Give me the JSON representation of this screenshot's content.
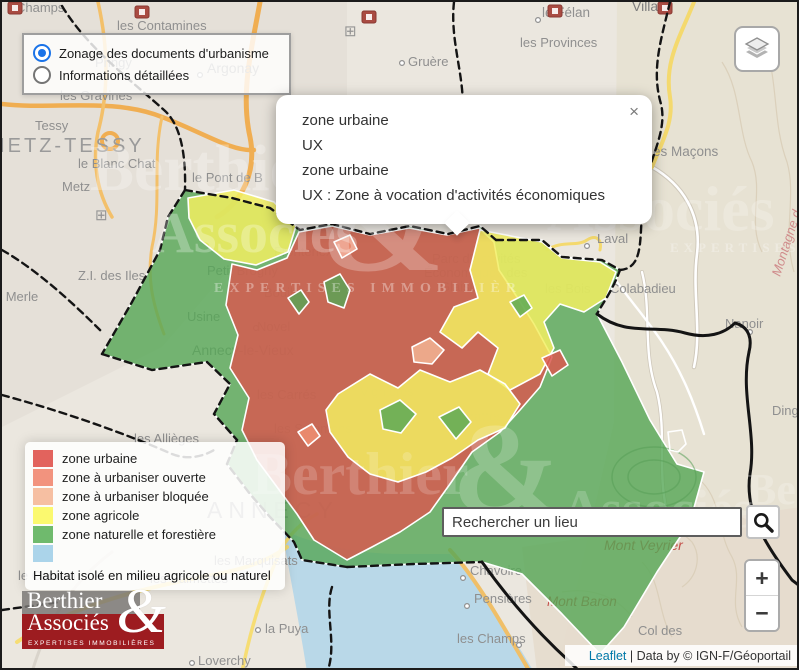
{
  "colors": {
    "zone_urbaine": "#e2635d",
    "zone_a_urbaniser_ouverte": "#f2937e",
    "zone_a_urbaniser_bloquee": "#f6bfa2",
    "zone_agricole": "#fbf96f",
    "zone_naturelle": "#6fba6d",
    "habitat_isole": "#abd4ea",
    "radio_accent": "#1a73e8",
    "leaflet_link": "#0078a8",
    "logo_red": "#9d1c20"
  },
  "mode_panel": {
    "options": [
      {
        "label": "Zonage des documents d'urbanisme",
        "selected": true
      },
      {
        "label": "Informations détaillées",
        "selected": false
      }
    ]
  },
  "popup": {
    "lines": [
      "zone urbaine",
      "UX",
      "zone urbaine",
      "UX : Zone à vocation d'activités économiques"
    ],
    "close_label": "×"
  },
  "legend": {
    "items": [
      {
        "label": "zone urbaine",
        "color": "#e2635d"
      },
      {
        "label": "zone à urbaniser ouverte",
        "color": "#f2937e"
      },
      {
        "label": "zone à urbaniser bloquée",
        "color": "#f6bfa2"
      },
      {
        "label": "zone agricole",
        "color": "#fbf96f"
      },
      {
        "label": "zone naturelle et forestière",
        "color": "#6fba6d"
      },
      {
        "label": "",
        "color": "#abd4ea"
      }
    ],
    "footnote": "Habitat isolé en milieu agricole ou naturel"
  },
  "search": {
    "placeholder": "Rechercher un lieu"
  },
  "zoom_control": {
    "zoom_in": "+",
    "zoom_out": "−"
  },
  "attribution": {
    "leaflet": "Leaflet",
    "separator": " | ",
    "text": "Data by © IGN-F/Géoportail"
  },
  "logo": {
    "line1": "Berthier",
    "line2": "Associés",
    "ampersand": "&",
    "tagline": "EXPERTISES IMMOBILIÈRES"
  },
  "map": {
    "base_shapes": [
      {
        "name": "urban-area-northwest",
        "path": "M0,0 L345,0 L345,130 L255,235 L160,345 L0,425 Z",
        "fill": "#e4dfd7",
        "op": 0.9
      },
      {
        "name": "mountain-area-east",
        "path": "M615,0 L799,0 L799,670 L555,670 L612,420 Z",
        "fill": "#e7e1d2",
        "op": 0.9
      },
      {
        "name": "shore-area-southeast",
        "path": "M520,545 L799,505 L799,670 L535,670 Z",
        "fill": "#e5dccd",
        "op": 0.9
      },
      {
        "name": "lake",
        "path": "M280,528 C320,545 360,552 400,552 L448,552 C470,575 495,612 520,650 L532,670 L305,670 C298,625 288,575 280,528 Z",
        "fill": "#b9d8e8",
        "op": 1
      }
    ],
    "roads": [
      {
        "path": "M650,165 C680,182 700,212 695,252 C690,290 700,330 692,365",
        "stroke": "#cfc8ba",
        "w": 4.5
      },
      {
        "path": "M650,165 C680,182 700,212 695,252 C690,290 700,330 692,365",
        "stroke": "#ffffff",
        "w": 2.6
      },
      {
        "path": "M640,270 C650,310 640,350 655,390 C665,430 655,470 665,510",
        "stroke": "#cfc8ba",
        "w": 4
      },
      {
        "path": "M640,270 C650,310 640,350 655,390 C665,430 655,470 665,510",
        "stroke": "#ffffff",
        "w": 2.4
      },
      {
        "path": "M600,258 C620,290 640,310 660,340 C680,370 692,400 702,432",
        "stroke": "#ffffff",
        "w": 2.4
      },
      {
        "path": "M258,0 C250,45 238,90 248,135 C255,170 240,200 215,215",
        "stroke": "#f0ae52",
        "w": 5
      },
      {
        "path": "M0,102 C50,108 110,95 160,115 C200,130 230,150 252,148",
        "stroke": "#f0ae52",
        "w": 4.5
      },
      {
        "path": "M96,0 C105,40 108,85 96,130 C90,160 95,190 110,215",
        "stroke": "#f3c06a",
        "w": 3.5
      },
      {
        "path": "M160,115 C150,160 160,200 150,245 C145,275 150,300 162,332",
        "stroke": "#f3c06a",
        "w": 3
      },
      {
        "circle": [
          108,
          139,
          8
        ],
        "stroke": "#f0ae52",
        "w": 4
      },
      {
        "path": "M692,0 C678,35 662,60 668,95 C672,120 660,140 650,165",
        "stroke": "#f4d96e",
        "w": 4
      },
      {
        "path": "M545,248 C560,238 575,245 585,238 C595,232 600,238 598,248",
        "stroke": "#f4d96e",
        "w": 3
      },
      {
        "path": "M15,640 C60,610 120,590 200,575 C240,568 265,560 285,545",
        "stroke": "#f6dd74",
        "w": 4
      },
      {
        "path": "M240,670 C250,620 262,585 280,545 C290,530 300,520 315,512",
        "stroke": "#f6dd74",
        "w": 3.5
      },
      {
        "path": "M448,548 C470,572 492,608 515,648 L528,670",
        "stroke": "#f0bf68",
        "w": 4
      },
      {
        "path": "M30,670 C45,620 70,580 110,550",
        "stroke": "#d9d4cb",
        "w": 3
      }
    ],
    "contours": [
      {
        "path": "M720,60 C740,90 735,130 750,160 C762,190 745,220 760,250"
      },
      {
        "path": "M762,40 C777,80 770,120 785,160 C795,195 780,230 792,270"
      },
      {
        "path": "M700,480 C720,500 715,530 730,555 C742,578 725,600 740,625"
      },
      {
        "path": "M640,560 C660,580 655,610 670,635"
      },
      {
        "path": "M610,520 C640,510 670,520 690,540 C700,555 695,575 680,585"
      },
      {
        "path": "M560,590 C590,585 615,595 630,615"
      }
    ],
    "labels": [
      {
        "t": "Champs",
        "x": 14,
        "y": 10
      },
      {
        "t": "les Contamines",
        "x": 115,
        "y": 28
      },
      {
        "t": "le Félan",
        "x": 540,
        "y": 15,
        "fs": 13.5
      },
      {
        "t": "les Provinces",
        "x": 518,
        "y": 45
      },
      {
        "t": "Villaz",
        "x": 630,
        "y": 9,
        "fs": 14,
        "c": "#7d7d7d"
      },
      {
        "t": "Gruère",
        "x": 406,
        "y": 64
      },
      {
        "t": "Argonay",
        "x": 205,
        "y": 71,
        "fs": 14
      },
      {
        "t": "Pringy",
        "x": 93,
        "y": 65
      },
      {
        "t": "les Gravines",
        "x": 58,
        "y": 98
      },
      {
        "t": "Tessy",
        "x": 33,
        "y": 128
      },
      {
        "t": "METZ-TESSY",
        "x": -14,
        "y": 150,
        "fs": 20,
        "ls": 3,
        "c": "#9a9a9a"
      },
      {
        "t": "le Blanc Chat",
        "x": 76,
        "y": 166
      },
      {
        "t": "Metz",
        "x": 60,
        "y": 189
      },
      {
        "t": "le Pont de B",
        "x": 190,
        "y": 180
      },
      {
        "t": "les Maçons",
        "x": 648,
        "y": 154,
        "fs": 13.5
      },
      {
        "t": "Z.I. des Iles",
        "x": 76,
        "y": 278
      },
      {
        "t": "le Merle",
        "x": -10,
        "y": 299
      },
      {
        "t": "Petit Brogny",
        "x": 205,
        "y": 273
      },
      {
        "t": "Laval",
        "x": 595,
        "y": 241
      },
      {
        "t": "les Bois",
        "x": 543,
        "y": 291
      },
      {
        "t": "Colabadieu",
        "x": 608,
        "y": 291
      },
      {
        "t": "Nanoir",
        "x": 723,
        "y": 326
      },
      {
        "t": "Frontenex",
        "x": 272,
        "y": 254
      },
      {
        "t": "Parc d'Activités",
        "x": 430,
        "y": 261
      },
      {
        "t": "Économiques des",
        "x": 422,
        "y": 275
      },
      {
        "t": "Glaisins",
        "x": 438,
        "y": 289
      },
      {
        "t": "Usine",
        "x": 185,
        "y": 319
      },
      {
        "t": "Annecy-le-Vieux",
        "x": 190,
        "y": 353,
        "fs": 14
      },
      {
        "t": "Novel",
        "x": 255,
        "y": 329
      },
      {
        "t": "Bouillon",
        "x": 262,
        "y": 295
      },
      {
        "t": "les Carrés",
        "x": 255,
        "y": 397
      },
      {
        "t": "Vignières",
        "x": 358,
        "y": 394
      },
      {
        "t": "les Barattes",
        "x": 430,
        "y": 419,
        "fs": 13.5
      },
      {
        "t": "les Salomons",
        "x": 272,
        "y": 431
      },
      {
        "t": "les Allièges",
        "x": 132,
        "y": 441
      },
      {
        "t": "ANNECY",
        "x": 205,
        "y": 516,
        "fs": 23,
        "ls": 6,
        "c": "#9a9a9a"
      },
      {
        "t": "les Marquisats",
        "x": 212,
        "y": 563
      },
      {
        "t": "les Balmettes",
        "x": 148,
        "y": 581
      },
      {
        "t": "le Carillon",
        "x": 16,
        "y": 578
      },
      {
        "t": "Loverchy",
        "x": 196,
        "y": 663
      },
      {
        "t": "la Puya",
        "x": 263,
        "y": 631
      },
      {
        "t": "Chavoire",
        "x": 468,
        "y": 573
      },
      {
        "t": "Pensières",
        "x": 472,
        "y": 601
      },
      {
        "t": "les Champs",
        "x": 455,
        "y": 641
      },
      {
        "t": "Col des",
        "x": 636,
        "y": 633
      },
      {
        "t": "Dingy",
        "x": 770,
        "y": 413
      },
      {
        "t": "Mont Veyrier",
        "x": 602,
        "y": 548,
        "fs": 14,
        "c": "#c4504a",
        "it": true
      },
      {
        "t": "Mont Baron",
        "x": 545,
        "y": 604,
        "fs": 13.5,
        "c": "#c4504a",
        "it": true
      },
      {
        "t": "Montagne d",
        "x": 778,
        "y": 275,
        "fs": 13,
        "c": "#d08c8c",
        "it": true,
        "rot": -72
      }
    ],
    "dots": [
      [
        536,
        18
      ],
      [
        400,
        61
      ],
      [
        198,
        73
      ],
      [
        585,
        244
      ],
      [
        748,
        330
      ],
      [
        461,
        576
      ],
      [
        465,
        604
      ],
      [
        256,
        628
      ],
      [
        190,
        661
      ],
      [
        517,
        643
      ],
      [
        254,
        326
      ]
    ],
    "icons": [
      {
        "type": "poi",
        "x": 6,
        "y": 0
      },
      {
        "type": "poi",
        "x": 133,
        "y": 4
      },
      {
        "type": "poi",
        "x": 360,
        "y": 9
      },
      {
        "type": "poi",
        "x": 546,
        "y": 3
      },
      {
        "type": "poi",
        "x": 656,
        "y": 0
      },
      {
        "type": "grid",
        "x": 342,
        "y": 34
      },
      {
        "type": "grid",
        "x": 93,
        "y": 218
      }
    ],
    "zones": [
      {
        "name": "zone-naturelle-silhouette",
        "fill": "#55a655",
        "op": 0.8,
        "path": "M183,188 L230,196 L268,206 L298,228 L330,222 L368,232 L408,224 L446,232 L478,224 L494,238 L540,238 L560,255 L600,258 L618,268 C610,290 600,302 595,312 L620,360 L648,418 L675,462 L702,470 L688,520 L655,570 L622,625 L598,652 L560,612 L520,572 L480,560 L412,562 L345,565 L300,558 L292,540 L268,515 L248,492 L225,462 L235,438 L212,412 L228,382 L205,360 L150,368 L100,352 L130,300 L158,248 L166,215 Z"
      },
      {
        "name": "zone-urbaine-main",
        "fill": "#d9584f",
        "op": 0.82,
        "path": "M230,262 L255,268 L285,256 L297,230 L330,224 L368,233 L407,226 L445,233 L477,226 L492,240 L497,268 L515,295 L532,322 L550,355 L538,385 L518,408 L498,430 L470,450 L448,482 L428,510 L398,530 L370,545 L345,558 L312,538 L295,512 L275,485 L255,458 L240,428 L247,396 L228,366 L236,333 L224,303 Z"
      },
      {
        "name": "zone-agricole-nw",
        "fill": "#f2ef62",
        "op": 0.85,
        "path": "M186,196 L232,188 L272,200 L294,224 L286,250 L254,263 L222,257 L198,238 L187,216 Z"
      },
      {
        "name": "zone-agricole-east",
        "fill": "#f2ef62",
        "op": 0.85,
        "path": "M478,228 L540,240 L560,256 L598,260 L614,270 L604,296 L582,310 L558,302 L542,320 L552,346 L538,372 L508,388 L486,372 L496,346 L476,330 L460,346 L438,330 L452,305 L476,296 L468,268 Z"
      },
      {
        "name": "zone-agricole-center",
        "fill": "#f2ef62",
        "op": 0.85,
        "path": "M336,392 L368,372 L396,386 L418,368 L448,380 L478,368 L503,382 L518,402 L503,426 L476,438 L450,456 L424,470 L396,480 L368,472 L346,455 L328,430 L324,408 Z"
      },
      {
        "name": "zone-naturelle-patch",
        "fill": "#55a655",
        "op": 0.8,
        "path": "M322,280 L338,272 L348,288 L342,306 L326,300 Z"
      },
      {
        "name": "zone-naturelle-patch",
        "fill": "#55a655",
        "op": 0.8,
        "path": "M286,296 L299,288 L307,300 L297,312 Z"
      },
      {
        "name": "zone-naturelle-patch",
        "fill": "#55a655",
        "op": 0.8,
        "path": "M378,408 L398,398 L414,412 L399,431 L381,427 Z"
      },
      {
        "name": "zone-naturelle-patch",
        "fill": "#55a655",
        "op": 0.8,
        "path": "M437,415 L457,405 L469,420 L454,437 Z"
      },
      {
        "name": "zone-naturelle-patch",
        "fill": "#55a655",
        "op": 0.8,
        "path": "M508,300 L522,293 L530,306 L518,315 Z"
      },
      {
        "name": "zone-a-urbaniser-bloquee-patch",
        "fill": "#f2b494",
        "op": 0.85,
        "path": "M410,345 L428,336 L442,348 L430,362 L412,360 Z"
      },
      {
        "name": "zone-a-urbaniser-ouverte-patch",
        "fill": "#ef8f72",
        "op": 0.85,
        "path": "M332,240 L348,233 L355,247 L340,256 Z"
      },
      {
        "name": "zone-a-urbaniser-ouverte-patch",
        "fill": "#ef8f72",
        "op": 0.85,
        "path": "M296,430 L310,422 L318,434 L306,444 Z"
      },
      {
        "name": "zone-urbaine-patch",
        "fill": "#d9584f",
        "op": 0.85,
        "path": "M540,356 L558,348 L566,363 L550,374 Z"
      },
      {
        "type": "ellipse",
        "name": "hill-contour-ring",
        "cx": 652,
        "cy": 475,
        "rx": 42,
        "ry": 30,
        "stroke": "#579f57"
      },
      {
        "type": "ellipse",
        "name": "hill-contour-ring",
        "cx": 652,
        "cy": 475,
        "rx": 26,
        "ry": 17,
        "stroke": "#579f57"
      },
      {
        "name": "unzoned-hole",
        "fill": "none",
        "op": 1,
        "path": "M668,448 L666,430 L680,428 L684,442 L676,450 Z"
      }
    ],
    "boundaries": [
      {
        "path": "M60,4 C85,45 125,75 162,108 C178,122 184,150 183,188",
        "dash": true
      },
      {
        "path": "M452,0 C447,45 468,85 458,125 C452,155 468,172 476,190",
        "dash": true
      },
      {
        "path": "M668,0 C659,38 649,68 659,102 C666,132 645,158 641,196 C637,235 643,266 618,268",
        "dash": true
      },
      {
        "path": "M183,188 L230,196 L268,206 L298,228 L330,222 L368,232 L408,224 L446,232 L478,224 L494,238",
        "dash": true
      },
      {
        "path": "M494,238 L540,238 L560,255 L600,258 L618,268 C610,290 600,302 595,312",
        "dash": true
      },
      {
        "path": "M595,312 C625,335 652,322 683,331 C705,337 722,332 733,321 C748,325 750,338 747,350",
        "dash": false
      },
      {
        "path": "M747,350 C738,392 755,432 748,472 C742,510 765,545 790,578 L799,585",
        "dash": false
      },
      {
        "path": "M183,188 L166,215 L158,248 L130,300 L100,352",
        "dash": true
      },
      {
        "path": "M100,352 L150,368 L205,360 L228,382 L212,412 L235,438 L225,462 L248,492 L268,515 L292,540 L300,558 L345,565",
        "dash": true
      },
      {
        "path": "M345,565 L412,562 L480,560",
        "dash": true
      },
      {
        "path": "M480,560 C505,595 535,630 568,660 L578,670",
        "dash": false
      },
      {
        "path": "M0,248 C35,268 70,300 100,330",
        "dash": true
      },
      {
        "path": "M0,393 C55,408 115,428 170,452 C185,458 200,455 212,448",
        "dash": true
      },
      {
        "path": "M330,585 C322,610 335,640 326,668",
        "dash": true
      },
      {
        "path": "M0,608 L58,600",
        "dash": true
      }
    ],
    "watermarks": [
      {
        "t": "Berthier",
        "x": 88,
        "y": 188,
        "fs": 66,
        "op": 0.28
      },
      {
        "t": "Associés",
        "x": 150,
        "y": 250,
        "fs": 58,
        "op": 0.28
      },
      {
        "t": "EXPERTISES IMMOBILIÈR",
        "x": 212,
        "y": 290,
        "fs": 14,
        "op": 0.35,
        "ls": 6
      },
      {
        "t": "&",
        "x": 318,
        "y": 268,
        "fs": 150,
        "op": 0.25
      },
      {
        "t": "Associés",
        "x": 545,
        "y": 228,
        "fs": 64,
        "op": 0.22
      },
      {
        "t": "EXPERTISES IM",
        "x": 668,
        "y": 250,
        "fs": 13,
        "op": 0.3,
        "ls": 5
      },
      {
        "t": "Berthier",
        "x": 250,
        "y": 492,
        "fs": 60,
        "op": 0.18
      },
      {
        "t": "&",
        "x": 450,
        "y": 510,
        "fs": 130,
        "op": 0.2
      },
      {
        "t": "Associés",
        "x": 560,
        "y": 525,
        "fs": 54,
        "op": 0.18
      },
      {
        "t": "Berthier",
        "x": 745,
        "y": 502,
        "fs": 44,
        "op": 0.22
      }
    ]
  }
}
